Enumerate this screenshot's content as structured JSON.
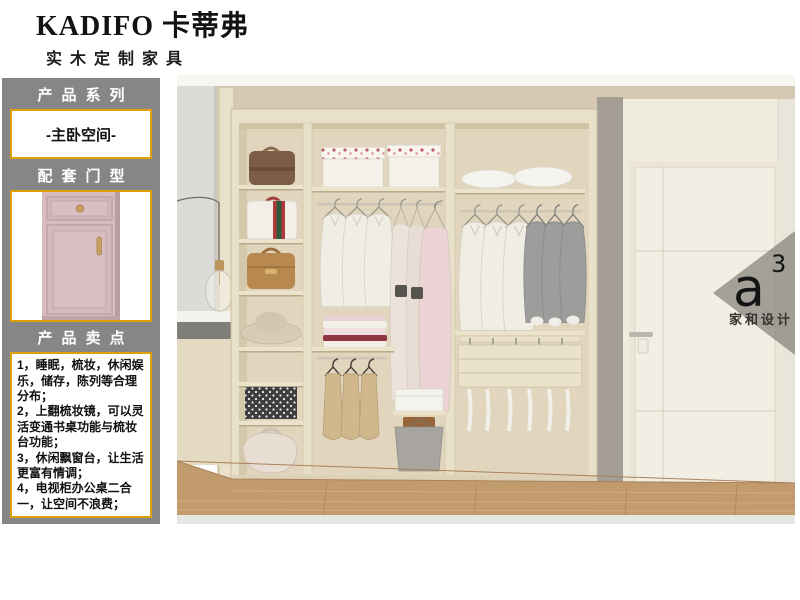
{
  "brand": {
    "logo": "KADIFO 卡蒂弗",
    "tagline": "实木定制家具"
  },
  "sidebar": {
    "series_title": "产品系列",
    "series_value": "-主卧空间-",
    "door_title": "配套门型",
    "selling_title": "产品卖点",
    "selling_points": [
      "1，睡眠，梳妆，休闲娱乐，储存，陈列等合理分布；",
      "2，上翻梳妆镜，可以灵活变通书桌功能与梳妆台功能；",
      "3，休闲飘窗台，让生活更富有情调；",
      "4，电视柜办公桌二合一，让空间不浪费；"
    ]
  },
  "watermark": {
    "letter": "a",
    "superscript": "3",
    "caption": "家和设计"
  },
  "colors": {
    "accent_gold": "#dfa005",
    "sidebar_gray": "#868686",
    "door_pink": "#d6bbbf",
    "wardrobe_cream": "#e9e0ca",
    "floor_wood": "#c19b6d"
  }
}
